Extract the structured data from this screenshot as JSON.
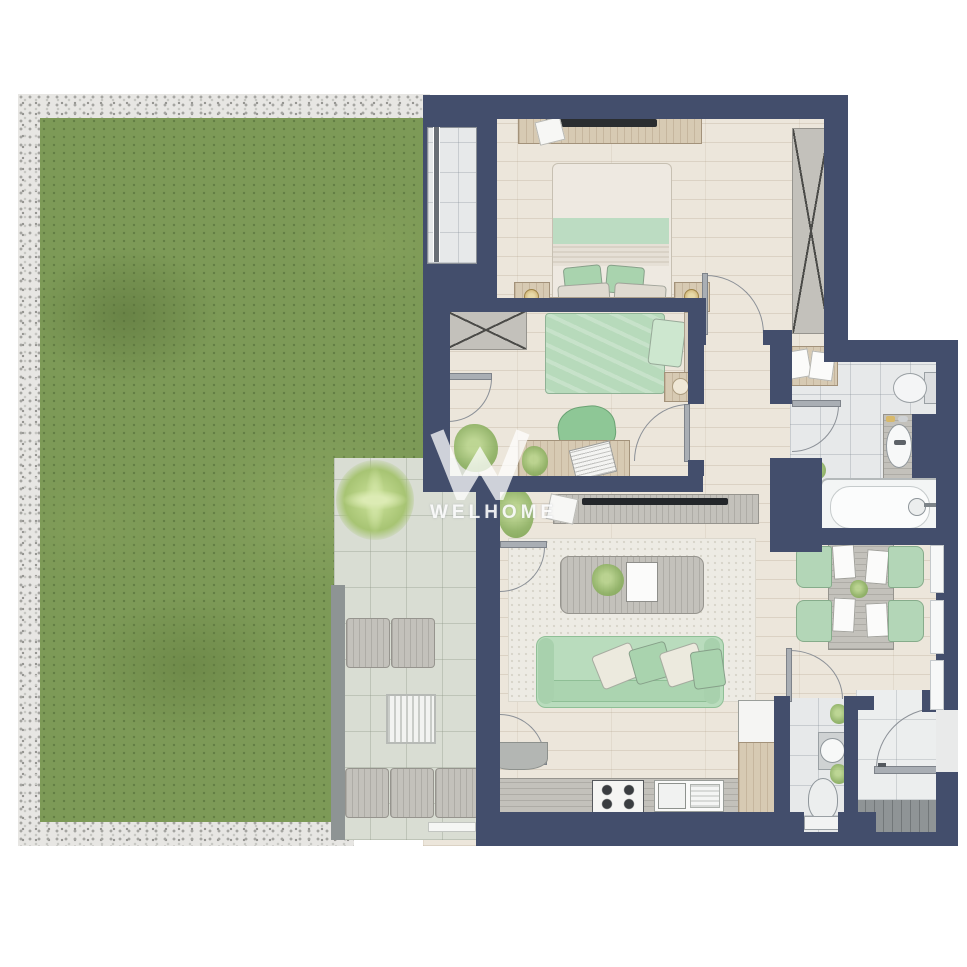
{
  "watermark": {
    "logo_letter": "W",
    "text": "WELHOME"
  },
  "palette": {
    "wall_navy": "#434e6c",
    "grass_green": "#7d9a57",
    "gravel_gray": "#e7e6e3",
    "wood_floor": "#ece6db",
    "tile_gray": "#e7e9ea",
    "terrace_gray": "#d9ddd3",
    "furniture_green": "#b7dcbb",
    "furniture_wood": "#d7cab3",
    "furniture_graywood": "#c3c1bb"
  },
  "legend": {
    "garden": [
      "lawn",
      "gravel-border"
    ],
    "terrace": [
      "palm-plant",
      "lounge-chairs",
      "slatted-table"
    ],
    "master-bedroom": [
      "double-bed",
      "nightstands",
      "tv-dresser",
      "wardrobe"
    ],
    "second-bedroom": [
      "single-bed",
      "desk",
      "desk-chair",
      "wardrobe",
      "side-table"
    ],
    "bathroom": [
      "bathtub",
      "vanity-sink",
      "toilet",
      "towel-shelf"
    ],
    "living-room": [
      "sofa",
      "coffee-table",
      "rug",
      "tv-console"
    ],
    "kitchen": [
      "stove",
      "sink",
      "fridge",
      "counter",
      "hood"
    ],
    "wc": [
      "toilet",
      "washbasin",
      "plants"
    ],
    "entry": [
      "entry-door",
      "doormat"
    ],
    "dining": [
      "dining-table",
      "chairs",
      "placemats"
    ]
  }
}
